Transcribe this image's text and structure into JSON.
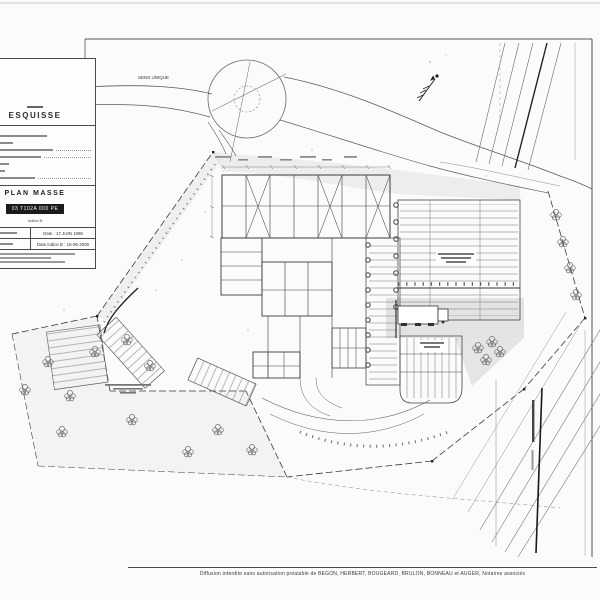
{
  "colors": {
    "paper": "#fbfbf9",
    "ink": "#333333",
    "shade": "#d8d8d6",
    "ref_box_bg": "#1b1b1b",
    "ref_box_text": "#f5f5f5"
  },
  "title_block": {
    "phase": "ESQUISSE",
    "title": "PLAN MASSE",
    "reference": "03 T102A 000 PE",
    "indice": "Indice B",
    "date_created": "Date : 17 JUIN 1998",
    "date_revised": "Date indice B : 16-06-2000"
  },
  "plan": {
    "one_way_label": "SENS UNIQUE"
  },
  "footer": {
    "note": "Diffusion interdite sans autorisation préalable de BEGON, HERBERT, BOUGEARD, BRULON, BONNEAU et AUGER, Notaires associés"
  }
}
